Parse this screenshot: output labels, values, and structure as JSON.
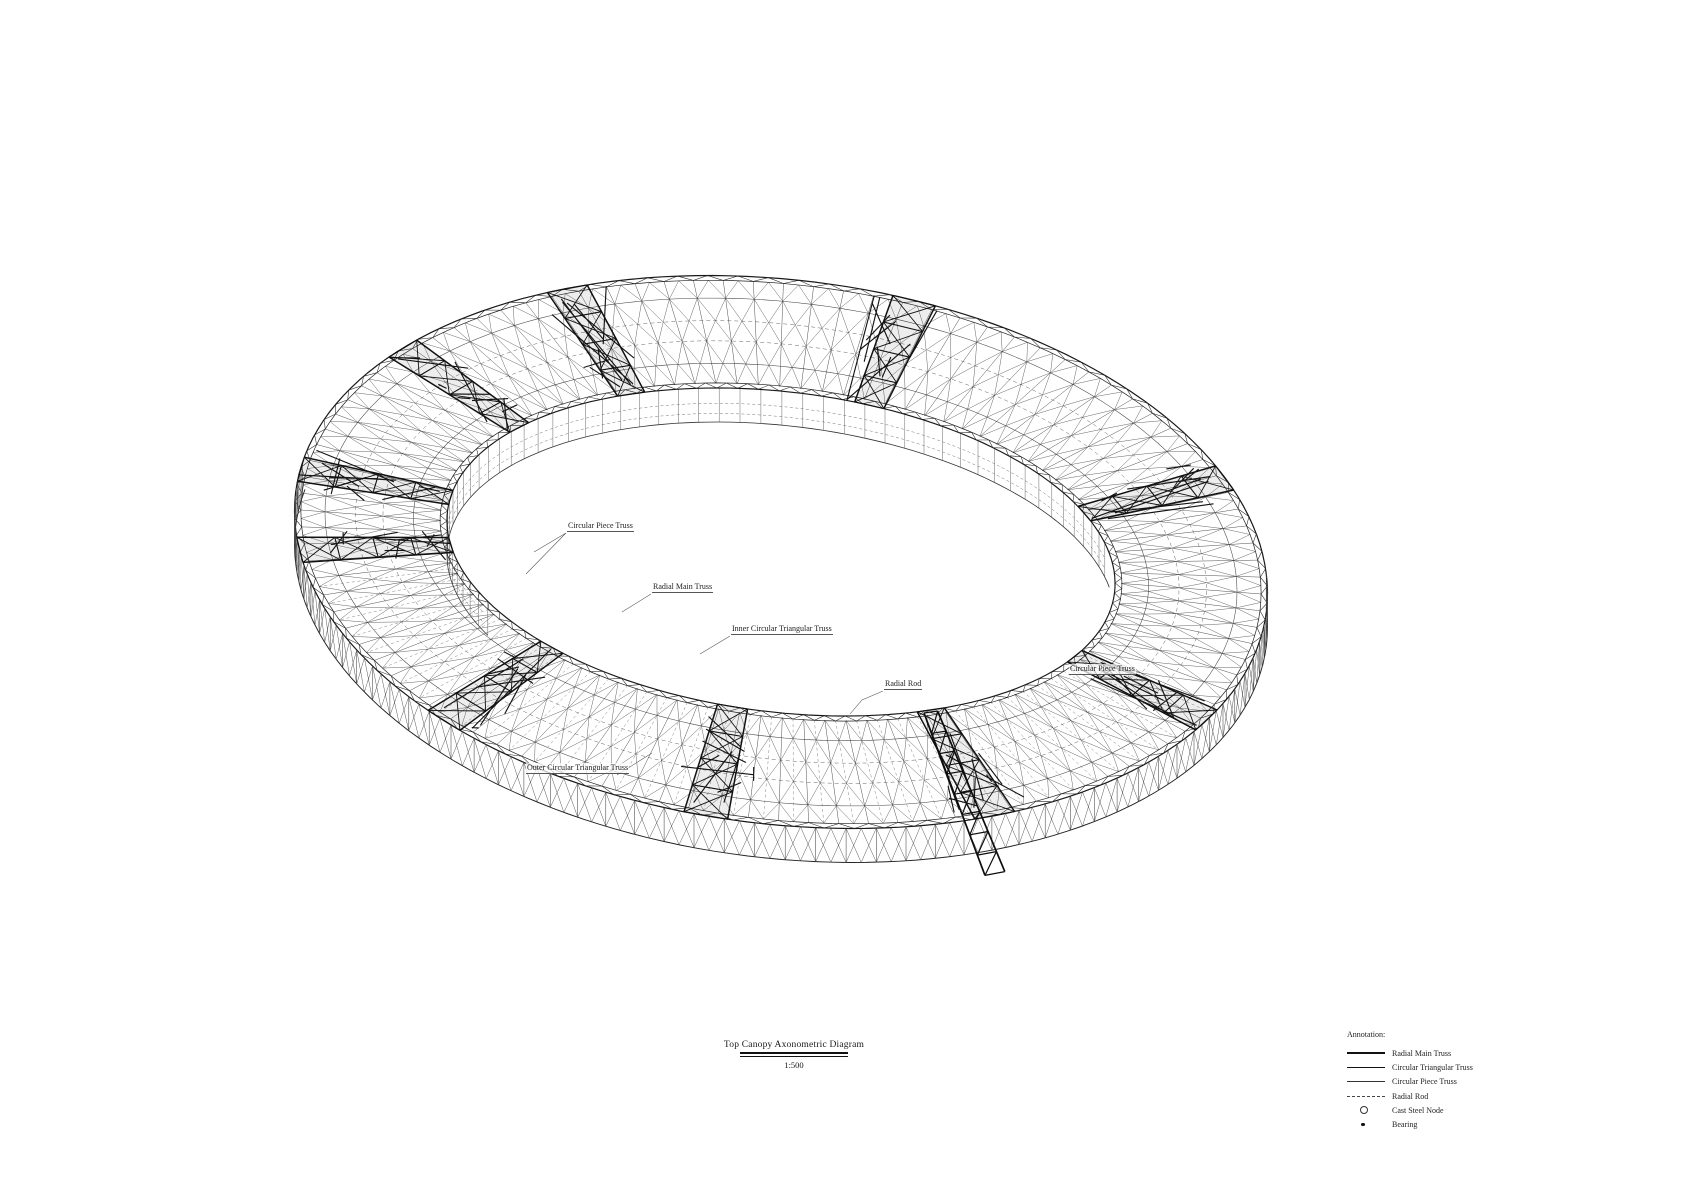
{
  "title": {
    "text": "Top Canopy Axonometric Diagram",
    "scale": "1:500"
  },
  "callouts": [
    {
      "text": "Circular Piece Truss"
    },
    {
      "text": "Radial Main Truss"
    },
    {
      "text": "Inner Circular Triangular Truss"
    },
    {
      "text": "Radial Rod"
    },
    {
      "text": "Circular Piece Truss"
    },
    {
      "text": "Outer Circular Triangular Truss"
    }
  ],
  "legend": {
    "heading": "Annotation:",
    "items": [
      {
        "label": "Radial Main Truss",
        "symbol": "line-thick"
      },
      {
        "label": "Circular Triangular Truss",
        "symbol": "line-medium"
      },
      {
        "label": "Circular Piece Truss",
        "symbol": "line-thin"
      },
      {
        "label": "Radial Rod",
        "symbol": "line-dashed"
      },
      {
        "label": "Cast Steel Node",
        "symbol": "circle-open"
      },
      {
        "label": "Bearing",
        "symbol": "dot-filled"
      }
    ]
  },
  "drawing": {
    "ink": "#1a1a1a",
    "background": "#ffffff"
  }
}
